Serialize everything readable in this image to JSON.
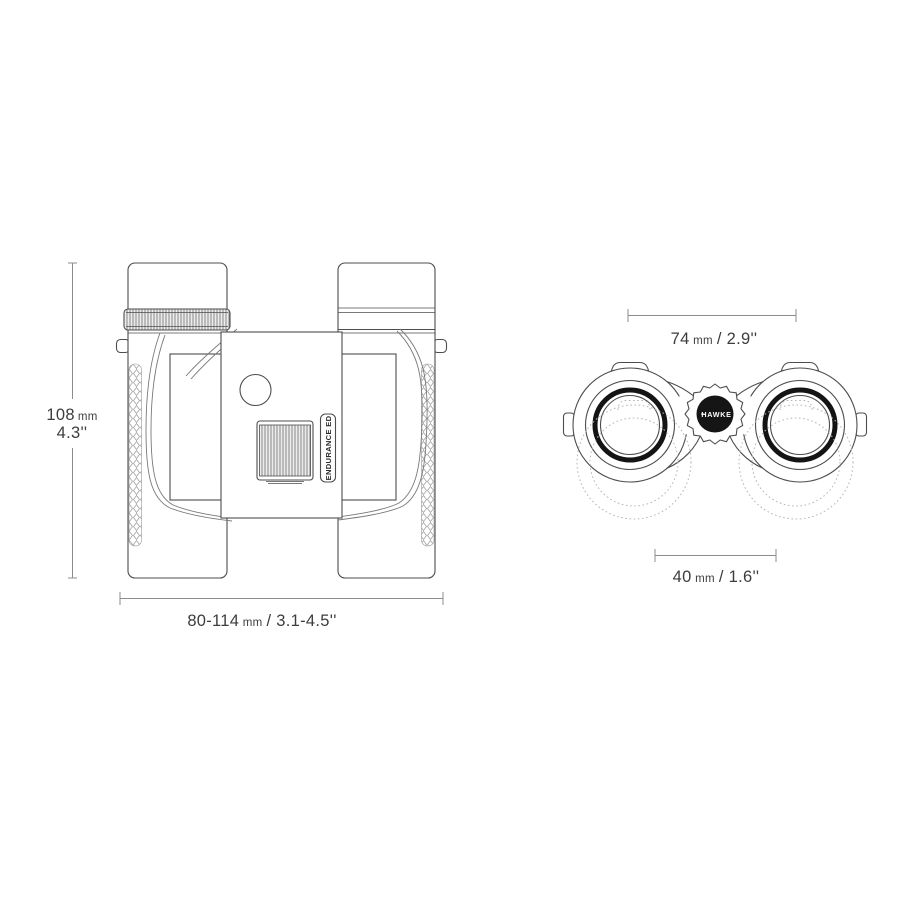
{
  "colors": {
    "background": "#ffffff",
    "line": "#4d4d4d",
    "dimension_line": "#8c8c8c",
    "text": "#3d3d3d",
    "logo_background": "#151515",
    "logo_text": "#ffffff",
    "ghost_line": "#b5b5b5"
  },
  "top_view": {
    "model_badge": "ENDURANCE ED",
    "height_dim": {
      "value": "108",
      "unit": "mm",
      "inches": "4.3''"
    },
    "width_dim": {
      "value": "80-114",
      "unit": "mm",
      "inches": "/ 3.1-4.5''"
    }
  },
  "front_view": {
    "logo": "HAWKE",
    "width_dim": {
      "value": "74",
      "unit": "mm",
      "inches": "/ 2.9''"
    },
    "objective_dim": {
      "value": "40",
      "unit": "mm",
      "inches": "/ 1.6''"
    }
  }
}
